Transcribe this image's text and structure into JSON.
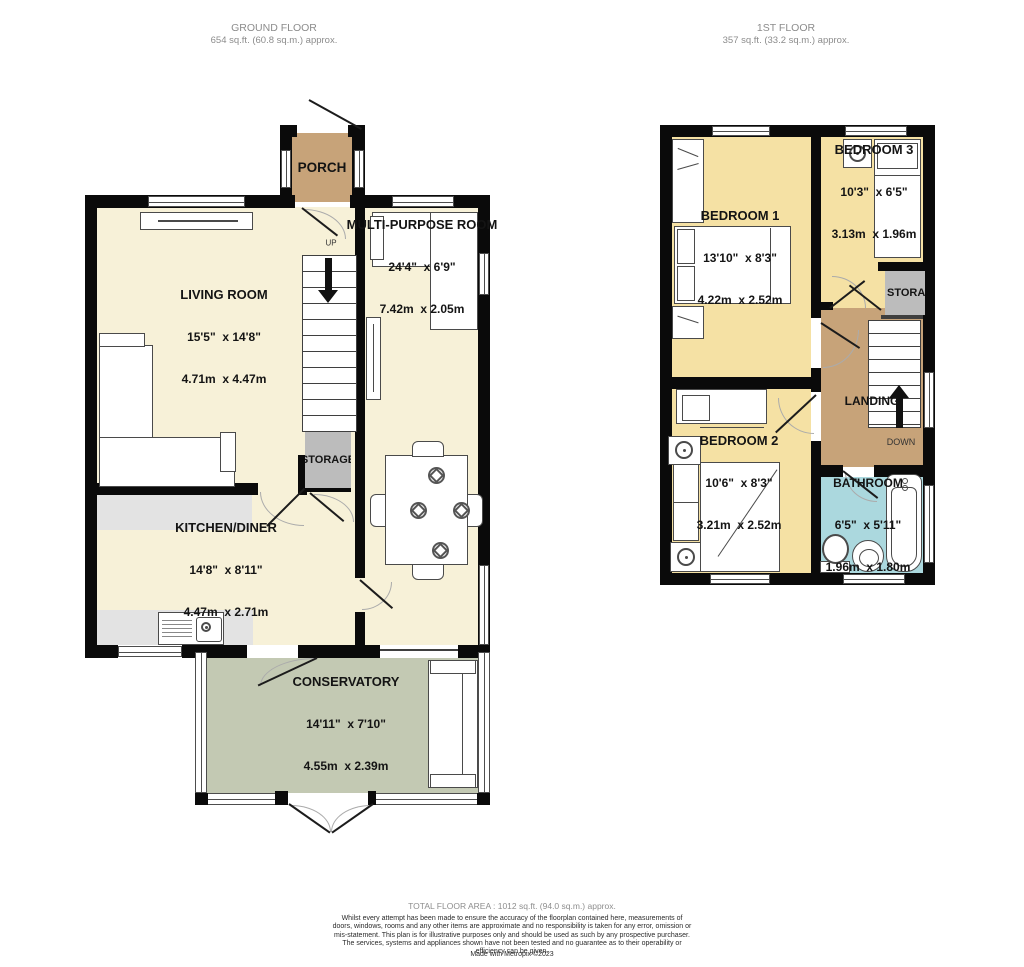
{
  "ground_floor": {
    "title": "GROUND FLOOR",
    "area": "654 sq.ft. (60.8 sq.m.) approx.",
    "rooms": {
      "porch": {
        "name": "PORCH"
      },
      "living_room": {
        "name": "LIVING ROOM",
        "dims_imperial": "15'5\"  x 14'8\"",
        "dims_metric": "4.71m  x 4.47m"
      },
      "multi_purpose": {
        "name": "MULTI-PURPOSE ROOM",
        "dims_imperial": "24'4\"  x 6'9\"",
        "dims_metric": "7.42m  x 2.05m"
      },
      "storage": {
        "name": "STORAGE"
      },
      "kitchen_diner": {
        "name": "KITCHEN/DINER",
        "dims_imperial": "14'8\"  x 8'11\"",
        "dims_metric": "4.47m  x 2.71m"
      },
      "conservatory": {
        "name": "CONSERVATORY",
        "dims_imperial": "14'11\"  x 7'10\"",
        "dims_metric": "4.55m  x 2.39m"
      }
    },
    "labels": {
      "up": "UP"
    }
  },
  "first_floor": {
    "title": "1ST FLOOR",
    "area": "357 sq.ft. (33.2 sq.m.) approx.",
    "rooms": {
      "bedroom1": {
        "name": "BEDROOM 1",
        "dims_imperial": "13'10\"  x 8'3\"",
        "dims_metric": "4.22m  x 2.52m"
      },
      "bedroom2": {
        "name": "BEDROOM 2",
        "dims_imperial": "10'6\"  x 8'3\"",
        "dims_metric": "3.21m  x 2.52m"
      },
      "bedroom3": {
        "name": "BEDROOM 3",
        "dims_imperial": "10'3\"  x 6'5\"",
        "dims_metric": "3.13m  x 1.96m"
      },
      "storage": {
        "name": "STORAGE"
      },
      "landing": {
        "name": "LANDING"
      },
      "bathroom": {
        "name": "BATHROOM",
        "dims_imperial": "6'5\"  x 5'11\"",
        "dims_metric": "1.96m  x 1.80m"
      }
    },
    "labels": {
      "down": "DOWN"
    }
  },
  "footer": {
    "total": "TOTAL FLOOR AREA : 1012 sq.ft. (94.0 sq.m.) approx.",
    "disclaimer": "Whilst every attempt has been made to ensure the accuracy of the floorplan contained here, measurements of doors, windows, rooms and any other items are approximate and no responsibility is taken for any error, omission or mis-statement. This plan is for illustrative purposes only and should be used as such by any prospective purchaser. The services, systems and appliances shown have not been tested and no guarantee as to their operability or efficiency can be given.",
    "credit": "Made with Metropix ©2023"
  },
  "colors": {
    "wall": "#0a0a0a",
    "room_cream": "#f7f1d8",
    "room_yellow": "#f5e1a4",
    "room_tan": "#c7a379",
    "room_sage": "#c3c9b3",
    "room_blue": "#abd8de",
    "storage_gray": "#bcbcbc",
    "counter_gray": "#e3e3e3"
  },
  "icons": {
    "ground_stairs_arrow": "down-triangle",
    "first_stairs_arrow": "up-triangle",
    "place_setting": "circle-with-diamond"
  }
}
